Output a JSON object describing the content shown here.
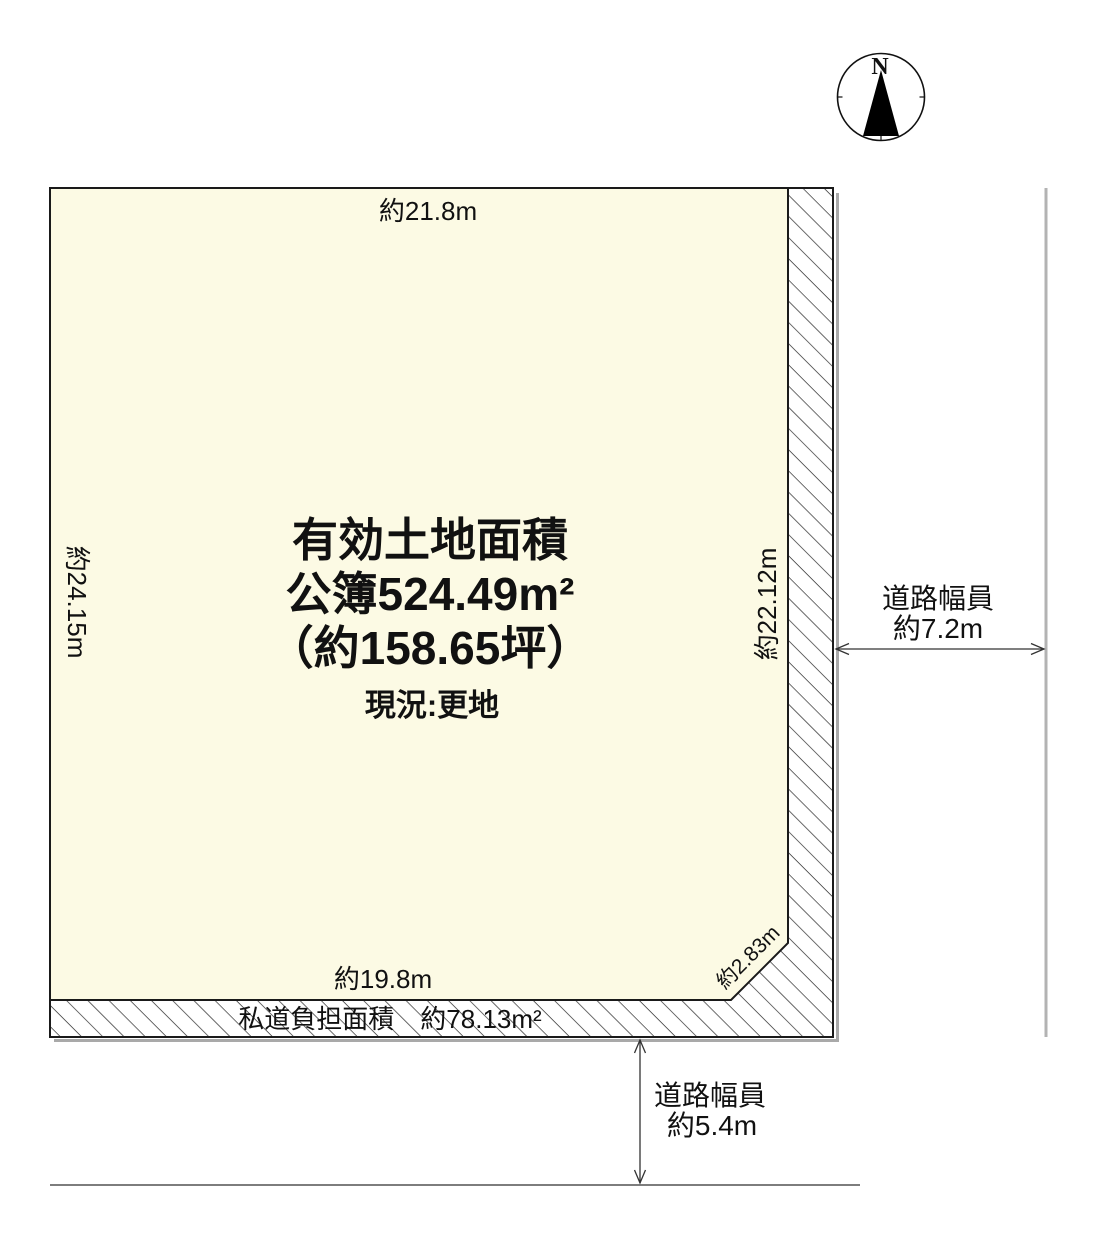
{
  "compass": {
    "label": "N"
  },
  "plot": {
    "area_title": "有効土地面積",
    "area_registered": "公簿524.49m²",
    "area_tsubo": "（約158.65坪）",
    "status": "現況:更地",
    "top_width": "約21.8m",
    "left_height": "約24.15m",
    "right_height": "約22.12m",
    "bottom_width": "約19.8m",
    "corner_cut": "約2.83m",
    "private_road_label": "私道負担面積　約78.13m²"
  },
  "roads": {
    "east": {
      "line1": "道路幅員",
      "line2": "約7.2m"
    },
    "south": {
      "line1": "道路幅員",
      "line2": "約5.4m"
    }
  },
  "colors": {
    "land_fill": "#FCFAE4",
    "outline": "#1a1a1a",
    "shadow_gray": "#a9a9a9",
    "guide_gray_vertical": "#b3b3b3",
    "guide_gray_horizontal": "#7d7d7d"
  }
}
